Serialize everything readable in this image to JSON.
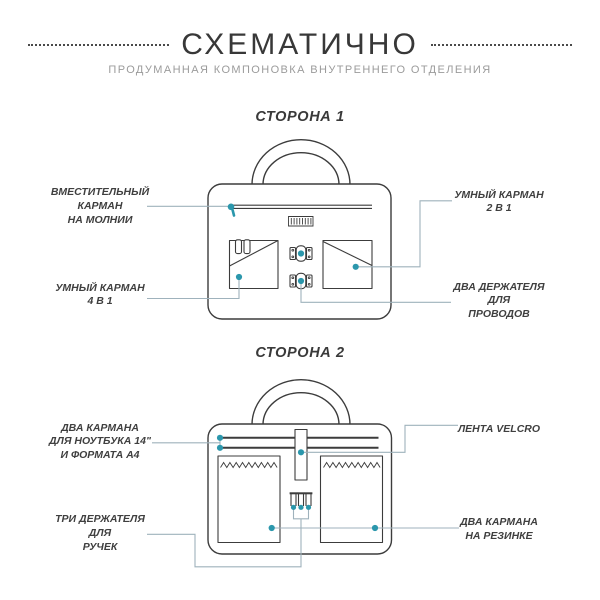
{
  "header": {
    "title": "СХЕМАТИЧНО",
    "subtitle": "ПРОДУМАННАЯ КОМПОНОВКА ВНУТРЕННЕГО ОТДЕЛЕНИЯ"
  },
  "colors": {
    "accent": "#2b97ac",
    "ink": "#3c3c3c",
    "connector": "#9fb2bc",
    "subtitle_gray": "#9b9b9b"
  },
  "side1": {
    "title": "СТОРОНА 1",
    "labels": {
      "zipper_pocket": "ВМЕСТИТЕЛЬНЫЙ\nКАРМАН\nНА МОЛНИИ",
      "smart_pocket_4in1": "УМНЫЙ КАРМАН\n4 В 1",
      "smart_pocket_2in1": "УМНЫЙ КАРМАН\n2 В 1",
      "wire_holders": "ДВА ДЕРЖАТЕЛЯ\nДЛЯ\nПРОВОДОВ"
    }
  },
  "side2": {
    "title": "СТОРОНА 2",
    "labels": {
      "laptop_pockets": "ДВА КАРМАНА\nДЛЯ НОУТБУКА 14\"\nИ ФОРМАТА А4",
      "velcro_strip": "ЛЕНТА VELCRO",
      "pen_holders": "ТРИ ДЕРЖАТЕЛЯ\nДЛЯ\nРУЧЕК",
      "elastic_pockets": "ДВА КАРМАНА\nНА РЕЗИНКЕ"
    }
  }
}
